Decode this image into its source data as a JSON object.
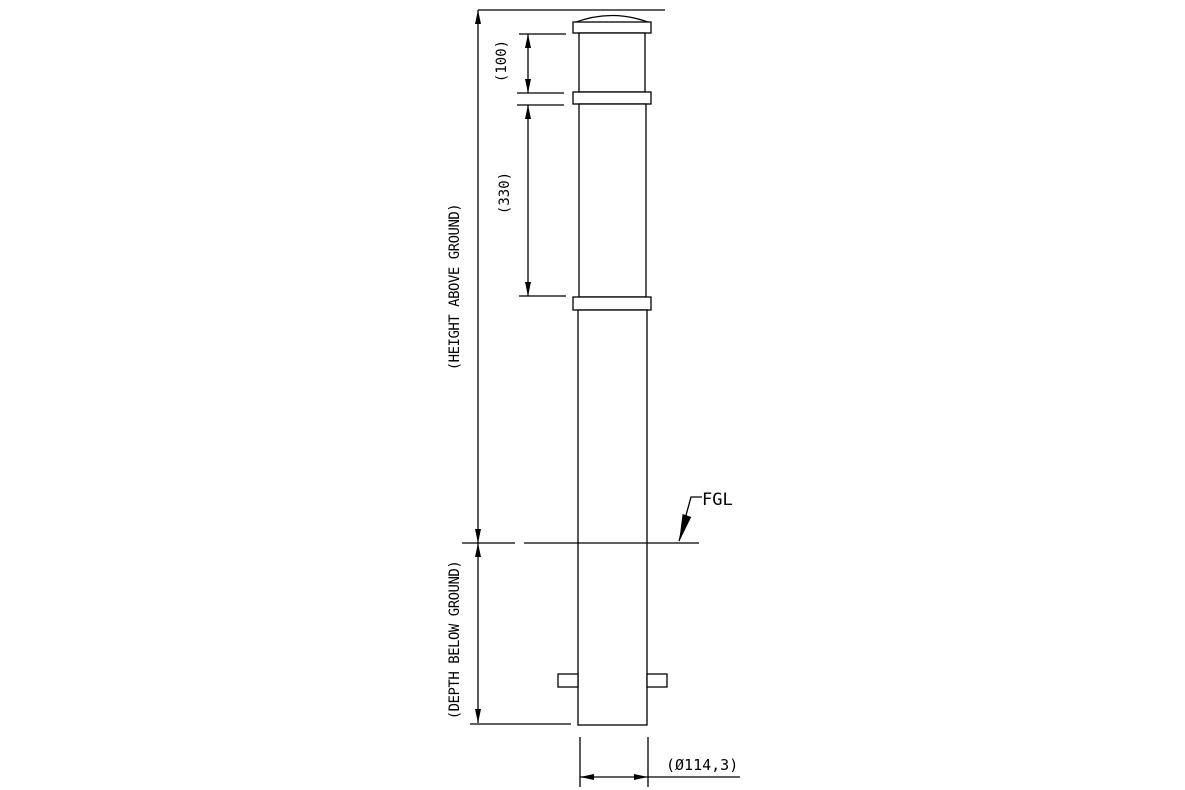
{
  "colors": {
    "background": "#ffffff",
    "line": "#000000"
  },
  "drawing": {
    "type": "bollard-elevation-technical-drawing",
    "annotations": {
      "cap_band_dim": "(100)",
      "band_spacing_dim": "(330)",
      "height_above_ground": "(HEIGHT ABOVE GROUND)",
      "depth_below_ground": "(DEPTH BELOW GROUND)",
      "ground_level_label": "FGL",
      "diameter_dim": "(Ø114,3)"
    }
  }
}
